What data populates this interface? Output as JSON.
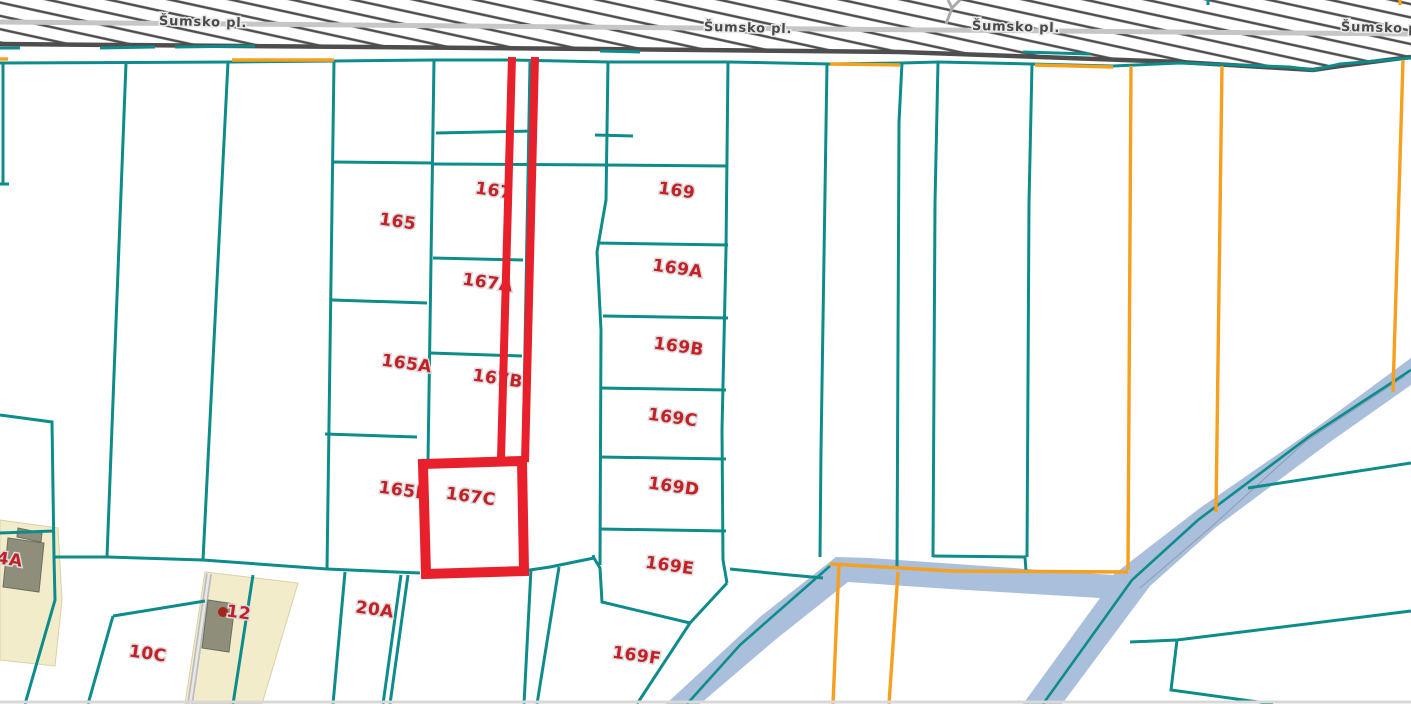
{
  "app": {
    "type": "cadastral-map-view"
  },
  "colors": {
    "boundary_teal": "#0E8C8C",
    "boundary_orange": "#F5A01E",
    "highlight_red": "#E8202C",
    "label_red": "#C32127",
    "label_halo": "#DCDCDC",
    "stream_fill": "#A9BFDB",
    "stream_centerline": "#0E8C8C",
    "road_hatch": "#4E4E4E",
    "road_strip": "#C6C6C6",
    "road_label": "#4A4A4A",
    "parcel_beige": "#F2ECCB",
    "beige_edge": "#D8D2A8",
    "building_gray": "#8E8E7B",
    "building_edge": "#6E6E5E",
    "path_gray": "#BDBDBD",
    "path_center": "#E8E8E8",
    "bottom_edge_gray": "#D8D8D8",
    "marker_dark_red": "#A3261C",
    "stream_inner_gray": "#8C9DB5"
  },
  "road": {
    "name": "Šumsko pl.",
    "labels": [
      {
        "text": "Šumsko pl.",
        "x": 203,
        "y": 26,
        "rot": 1.5
      },
      {
        "text": "Šumsko pl.",
        "x": 748,
        "y": 32,
        "rot": 1.5
      },
      {
        "text": "Šumsko pl.",
        "x": 1016,
        "y": 31,
        "rot": 1.5
      },
      {
        "text": "Šumsko pl.",
        "x": 1385,
        "y": 32,
        "rot": 1.5
      }
    ],
    "band": [
      [
        0,
        0
      ],
      [
        1411,
        0
      ],
      [
        1411,
        57
      ],
      [
        1340,
        66
      ],
      [
        1313,
        70
      ],
      [
        1180,
        62
      ],
      [
        900,
        52
      ],
      [
        600,
        49
      ],
      [
        0,
        44
      ]
    ],
    "band_bottom": [
      [
        0,
        44
      ],
      [
        600,
        49
      ],
      [
        900,
        52
      ],
      [
        1180,
        62
      ],
      [
        1313,
        70
      ],
      [
        1340,
        66
      ],
      [
        1411,
        57
      ]
    ],
    "centerline": [
      [
        0,
        22
      ],
      [
        700,
        28
      ],
      [
        1411,
        34
      ]
    ],
    "side_path": [
      [
        [
          946,
          24
        ],
        [
          952,
          8
        ],
        [
          948,
          0
        ]
      ],
      [
        [
          952,
          8
        ],
        [
          960,
          0
        ]
      ]
    ]
  },
  "parcels": {
    "labels": [
      {
        "text": "165",
        "x": 397,
        "y": 227,
        "rot": 8
      },
      {
        "text": "167",
        "x": 493,
        "y": 196,
        "rot": 8
      },
      {
        "text": "167A",
        "x": 487,
        "y": 288,
        "rot": 8
      },
      {
        "text": "165A",
        "x": 406,
        "y": 369,
        "rot": 8
      },
      {
        "text": "167B",
        "x": 497,
        "y": 384,
        "rot": 8
      },
      {
        "text": "165B",
        "x": 403,
        "y": 496,
        "rot": 8
      },
      {
        "text": "167C",
        "x": 470,
        "y": 502,
        "rot": 8
      },
      {
        "text": "169",
        "x": 676,
        "y": 196,
        "rot": 8
      },
      {
        "text": "169A",
        "x": 677,
        "y": 274,
        "rot": 8
      },
      {
        "text": "169B",
        "x": 678,
        "y": 352,
        "rot": 8
      },
      {
        "text": "169C",
        "x": 672,
        "y": 423,
        "rot": 8
      },
      {
        "text": "169D",
        "x": 673,
        "y": 492,
        "rot": 8
      },
      {
        "text": "169E",
        "x": 669,
        "y": 571,
        "rot": 8
      },
      {
        "text": "169F",
        "x": 636,
        "y": 661,
        "rot": 8
      },
      {
        "text": "20A",
        "x": 374,
        "y": 615,
        "rot": 8
      },
      {
        "text": "12",
        "x": 238,
        "y": 618,
        "rot": 8
      },
      {
        "text": "10C",
        "x": 147,
        "y": 659,
        "rot": 8
      },
      {
        "text": "4A",
        "x": 9,
        "y": 565,
        "rot": 8
      }
    ],
    "teal_boundaries": [
      [
        [
          0,
          63
        ],
        [
          232,
          62
        ],
        [
          334,
          61
        ],
        [
          434,
          60
        ],
        [
          512,
          60
        ],
        [
          608,
          62
        ],
        [
          728,
          62
        ],
        [
          830,
          64
        ],
        [
          902,
          63
        ],
        [
          938,
          62
        ],
        [
          1032,
          64
        ],
        [
          1113,
          66
        ],
        [
          1180,
          63
        ],
        [
          1290,
          67
        ],
        [
          1313,
          70
        ],
        [
          1340,
          64
        ],
        [
          1411,
          58
        ]
      ],
      [
        [
          3,
          63
        ],
        [
          3,
          183
        ]
      ],
      [
        [
          0,
          184
        ],
        [
          9,
          184
        ]
      ],
      [
        [
          126,
          63
        ],
        [
          107,
          557
        ]
      ],
      [
        [
          228,
          62
        ],
        [
          203,
          560
        ]
      ],
      [
        [
          334,
          61
        ],
        [
          327,
          570
        ]
      ],
      [
        [
          434,
          60
        ],
        [
          428,
          461
        ]
      ],
      [
        [
          530,
          62
        ],
        [
          523,
          460
        ]
      ],
      [
        [
          608,
          62
        ],
        [
          606,
          200
        ],
        [
          597,
          252
        ],
        [
          601,
          330
        ],
        [
          600,
          565
        ]
      ],
      [
        [
          728,
          62
        ],
        [
          726,
          250
        ],
        [
          722,
          430
        ],
        [
          723,
          560
        ],
        [
          727,
          583
        ]
      ],
      [
        [
          827,
          63
        ],
        [
          821,
          450
        ],
        [
          820,
          557
        ]
      ],
      [
        [
          902,
          63
        ],
        [
          899,
          122
        ],
        [
          897,
          569
        ]
      ],
      [
        [
          938,
          62
        ],
        [
          935,
          203
        ],
        [
          933,
          557
        ]
      ],
      [
        [
          1032,
          64
        ],
        [
          1029,
          203
        ],
        [
          1027,
          557
        ]
      ],
      [
        [
          933,
          556
        ],
        [
          1025,
          557
        ],
        [
          1026,
          571
        ]
      ],
      [
        [
          332,
          162
        ],
        [
          433,
          163
        ]
      ],
      [
        [
          332,
          300
        ],
        [
          427,
          303
        ]
      ],
      [
        [
          325,
          434
        ],
        [
          417,
          437
        ]
      ],
      [
        [
          436,
          133
        ],
        [
          536,
          131
        ]
      ],
      [
        [
          433,
          164
        ],
        [
          608,
          165
        ]
      ],
      [
        [
          433,
          258
        ],
        [
          523,
          260
        ]
      ],
      [
        [
          430,
          353
        ],
        [
          522,
          356
        ]
      ],
      [
        [
          595,
          135
        ],
        [
          633,
          136
        ]
      ],
      [
        [
          603,
          165
        ],
        [
          728,
          166
        ]
      ],
      [
        [
          597,
          243
        ],
        [
          728,
          245
        ]
      ],
      [
        [
          603,
          316
        ],
        [
          728,
          318
        ]
      ],
      [
        [
          600,
          388
        ],
        [
          726,
          390
        ]
      ],
      [
        [
          600,
          457
        ],
        [
          726,
          459
        ]
      ],
      [
        [
          600,
          529
        ],
        [
          726,
          531
        ]
      ],
      [
        [
          0,
          415
        ],
        [
          52,
          422
        ],
        [
          54,
          557
        ]
      ],
      [
        [
          54,
          557
        ],
        [
          107,
          557
        ],
        [
          203,
          560
        ],
        [
          327,
          569
        ],
        [
          420,
          573
        ]
      ],
      [
        [
          523,
          571
        ],
        [
          550,
          567
        ],
        [
          594,
          558
        ]
      ],
      [
        [
          593,
          555
        ],
        [
          594,
          558
        ]
      ],
      [
        [
          594,
          558
        ],
        [
          600,
          568
        ],
        [
          602,
          602
        ],
        [
          690,
          623
        ]
      ],
      [
        [
          727,
          583
        ],
        [
          690,
          623
        ]
      ],
      [
        [
          690,
          623
        ],
        [
          637,
          704
        ]
      ],
      [
        [
          730,
          569
        ],
        [
          790,
          575
        ],
        [
          823,
          578
        ]
      ],
      [
        [
          54,
          557
        ],
        [
          55,
          600
        ],
        [
          25,
          704
        ]
      ],
      [
        [
          113,
          616
        ],
        [
          205,
          601
        ]
      ],
      [
        [
          113,
          616
        ],
        [
          88,
          704
        ]
      ],
      [
        [
          0,
          533
        ],
        [
          53,
          531
        ]
      ],
      [
        [
          253,
          575
        ],
        [
          233,
          704
        ]
      ],
      [
        [
          345,
          572
        ],
        [
          333,
          704
        ]
      ],
      [
        [
          401,
          575
        ],
        [
          383,
          704
        ]
      ],
      [
        [
          408,
          575
        ],
        [
          390,
          704
        ]
      ],
      [
        [
          531,
          569
        ],
        [
          524,
          704
        ]
      ],
      [
        [
          559,
          567
        ],
        [
          537,
          704
        ]
      ],
      [
        [
          1130,
          642
        ],
        [
          1177,
          640
        ],
        [
          1411,
          611
        ]
      ],
      [
        [
          1177,
          640
        ],
        [
          1171,
          690
        ],
        [
          1273,
          704
        ]
      ],
      [
        [
          1248,
          488
        ],
        [
          1411,
          463
        ]
      ],
      [
        [
          0,
          48
        ],
        [
          20,
          48
        ]
      ],
      [
        [
          100,
          48
        ],
        [
          155,
          47
        ]
      ],
      [
        [
          175,
          47
        ],
        [
          255,
          46
        ]
      ],
      [
        [
          600,
          51
        ],
        [
          640,
          52
        ]
      ],
      [
        [
          1023,
          52
        ],
        [
          1090,
          54
        ]
      ],
      [
        [
          1208,
          0
        ],
        [
          1208,
          5
        ]
      ]
    ],
    "orange_boundaries": [
      [
        [
          0,
          59
        ],
        [
          8,
          59
        ]
      ],
      [
        [
          232,
          60
        ],
        [
          334,
          60
        ]
      ],
      [
        [
          830,
          64
        ],
        [
          900,
          65
        ]
      ],
      [
        [
          1035,
          65
        ],
        [
          1113,
          67
        ]
      ],
      [
        [
          1131,
          66
        ],
        [
          1128,
          570
        ]
      ],
      [
        [
          1222,
          66
        ],
        [
          1216,
          512
        ]
      ],
      [
        [
          1403,
          60
        ],
        [
          1393,
          392
        ]
      ],
      [
        [
          830,
          564
        ],
        [
          953,
          571
        ],
        [
          1128,
          572
        ]
      ],
      [
        [
          839,
          563
        ],
        [
          833,
          704
        ]
      ],
      [
        [
          898,
          572
        ],
        [
          889,
          704
        ]
      ],
      [
        [
          1400,
          0
        ],
        [
          1400,
          5
        ]
      ]
    ]
  },
  "highlight": {
    "strip_lines": [
      [
        [
          512,
          57
        ],
        [
          501,
          458
        ]
      ],
      [
        [
          535,
          57
        ],
        [
          525,
          462
        ]
      ]
    ],
    "rect": [
      [
        423,
        464
      ],
      [
        522,
        461
      ],
      [
        524,
        571
      ],
      [
        426,
        574
      ]
    ]
  },
  "stream": {
    "polygon": [
      [
        666,
        704
      ],
      [
        760,
        617
      ],
      [
        836,
        557
      ],
      [
        870,
        558
      ],
      [
        1113,
        575
      ],
      [
        1200,
        508
      ],
      [
        1320,
        425
      ],
      [
        1411,
        358
      ],
      [
        1411,
        385
      ],
      [
        1330,
        442
      ],
      [
        1215,
        528
      ],
      [
        1150,
        586
      ],
      [
        1062,
        704
      ],
      [
        1023,
        704
      ],
      [
        1100,
        598
      ],
      [
        950,
        589
      ],
      [
        848,
        582
      ],
      [
        775,
        640
      ],
      [
        700,
        704
      ]
    ],
    "centerlines": [
      [
        [
          687,
          704
        ],
        [
          740,
          645
        ],
        [
          830,
          566
        ]
      ],
      [
        [
          1411,
          370
        ],
        [
          1310,
          436
        ],
        [
          1198,
          520
        ],
        [
          1132,
          580
        ],
        [
          1043,
          704
        ]
      ]
    ],
    "inner_lines": [
      [
        [
          1405,
          376
        ],
        [
          1305,
          442
        ],
        [
          1210,
          528
        ],
        [
          1140,
          588
        ]
      ]
    ]
  },
  "areas": {
    "beige_parcels": [
      [
        [
          0,
          520
        ],
        [
          58,
          528
        ],
        [
          62,
          600
        ],
        [
          55,
          666
        ],
        [
          0,
          660
        ]
      ],
      [
        [
          205,
          572
        ],
        [
          298,
          583
        ],
        [
          262,
          704
        ],
        [
          185,
          704
        ]
      ]
    ],
    "buildings": [
      [
        [
          8,
          538
        ],
        [
          44,
          543
        ],
        [
          39,
          592
        ],
        [
          3,
          587
        ]
      ],
      [
        [
          18,
          528
        ],
        [
          42,
          533
        ],
        [
          41,
          542
        ],
        [
          17,
          537
        ]
      ],
      [
        [
          208,
          600
        ],
        [
          235,
          604
        ],
        [
          229,
          652
        ],
        [
          202,
          648
        ]
      ]
    ],
    "gray_path": [
      [
        209,
        574
      ],
      [
        190,
        704
      ]
    ],
    "marker_dot": {
      "x": 223,
      "y": 612,
      "r": 5
    }
  },
  "misc": {
    "bottom_edge": [
      [
        0,
        702
      ],
      [
        1411,
        702
      ]
    ]
  }
}
